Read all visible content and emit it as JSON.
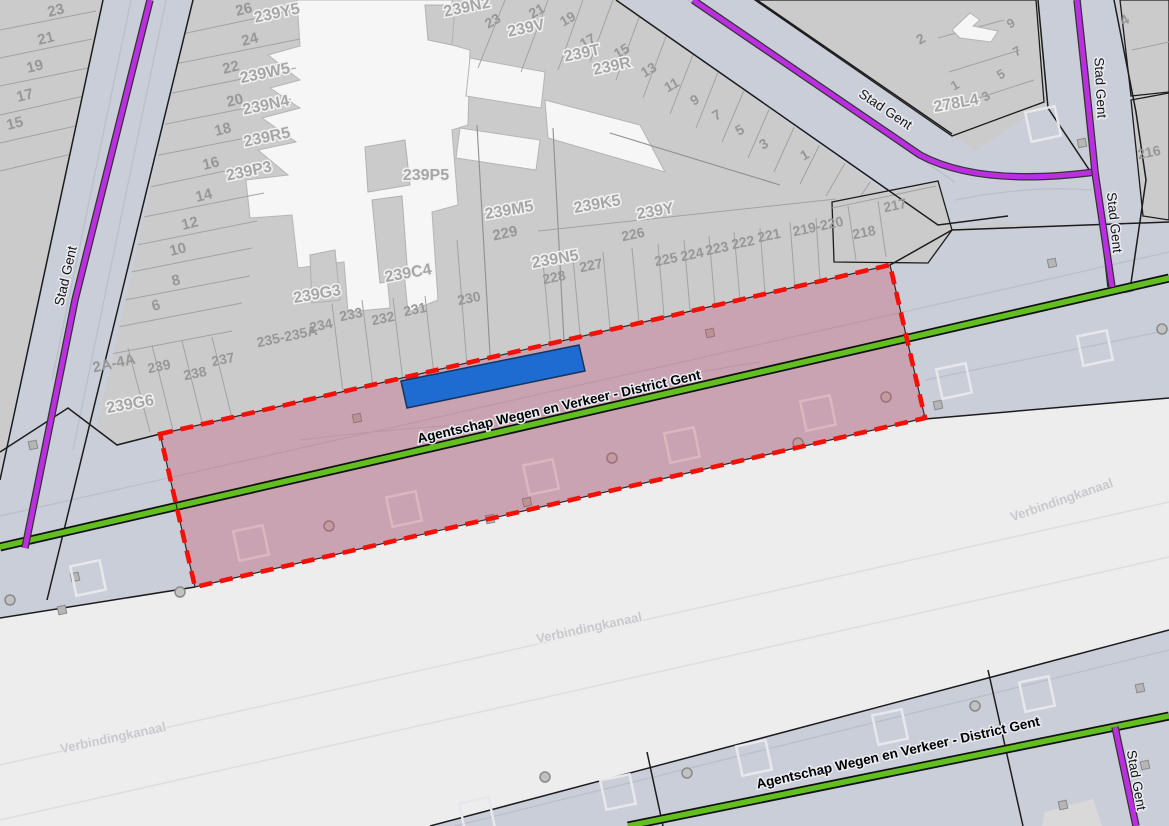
{
  "map": {
    "description": "Cadastral GIS map with selected road parcel",
    "colors": {
      "parcel_fill": "#cbcbcb",
      "road_fill": "#c9ced9",
      "canal_fill": "#ededee",
      "building_fill": "#f6f6f6",
      "selection_red": "#f50f05",
      "selection_pink_fill": "rgba(200,55,75,0.28)",
      "highlight_blue": "#1e6bd2",
      "road_line_green": "#62bf1f",
      "road_line_purple": "#bb2fe0"
    },
    "parcel_numbers": [
      {
        "t": "23",
        "x": 57,
        "y": 15,
        "r": -14,
        "fs": 15
      },
      {
        "t": "21",
        "x": 47,
        "y": 43,
        "r": -14,
        "fs": 15
      },
      {
        "t": "19",
        "x": 36,
        "y": 71,
        "r": -14,
        "fs": 15
      },
      {
        "t": "17",
        "x": 26,
        "y": 100,
        "r": -14,
        "fs": 15
      },
      {
        "t": "15",
        "x": 16,
        "y": 128,
        "r": -14,
        "fs": 15
      },
      {
        "t": "26",
        "x": 245,
        "y": 14,
        "r": -14,
        "fs": 15
      },
      {
        "t": "24",
        "x": 251,
        "y": 44,
        "r": -14,
        "fs": 15
      },
      {
        "t": "22",
        "x": 232,
        "y": 72,
        "r": -14,
        "fs": 15
      },
      {
        "t": "20",
        "x": 236,
        "y": 105,
        "r": -14,
        "fs": 15
      },
      {
        "t": "18",
        "x": 224,
        "y": 134,
        "r": -14,
        "fs": 15
      },
      {
        "t": "16",
        "x": 212,
        "y": 168,
        "r": -14,
        "fs": 15
      },
      {
        "t": "14",
        "x": 205,
        "y": 200,
        "r": -14,
        "fs": 15
      },
      {
        "t": "12",
        "x": 191,
        "y": 228,
        "r": -14,
        "fs": 15
      },
      {
        "t": "10",
        "x": 179,
        "y": 254,
        "r": -14,
        "fs": 15
      },
      {
        "t": "8",
        "x": 177,
        "y": 285,
        "r": -14,
        "fs": 15
      },
      {
        "t": "6",
        "x": 157,
        "y": 310,
        "r": -14,
        "fs": 15
      },
      {
        "t": "23",
        "x": 495,
        "y": 25,
        "r": -30,
        "fs": 14
      },
      {
        "t": "21",
        "x": 539,
        "y": 15,
        "r": -30,
        "fs": 14
      },
      {
        "t": "19",
        "x": 570,
        "y": 23,
        "r": -30,
        "fs": 14
      },
      {
        "t": "17",
        "x": 590,
        "y": 45,
        "r": -30,
        "fs": 14
      },
      {
        "t": "15",
        "x": 624,
        "y": 55,
        "r": -30,
        "fs": 14
      },
      {
        "t": "13",
        "x": 651,
        "y": 74,
        "r": -30,
        "fs": 14
      },
      {
        "t": "11",
        "x": 674,
        "y": 89,
        "r": -30,
        "fs": 14
      },
      {
        "t": "9",
        "x": 697,
        "y": 104,
        "r": -30,
        "fs": 14
      },
      {
        "t": "7",
        "x": 719,
        "y": 119,
        "r": -30,
        "fs": 14
      },
      {
        "t": "5",
        "x": 742,
        "y": 134,
        "r": -30,
        "fs": 14
      },
      {
        "t": "3",
        "x": 766,
        "y": 148,
        "r": -30,
        "fs": 14
      },
      {
        "t": "1",
        "x": 807,
        "y": 159,
        "r": -30,
        "fs": 14
      },
      {
        "t": "2",
        "x": 923,
        "y": 43,
        "r": -30,
        "fs": 14
      },
      {
        "t": "4",
        "x": 1127,
        "y": 24,
        "r": -30,
        "fs": 14
      },
      {
        "t": "9",
        "x": 1013,
        "y": 27,
        "r": -30,
        "fs": 13
      },
      {
        "t": "7",
        "x": 1019,
        "y": 55,
        "r": -30,
        "fs": 13
      },
      {
        "t": "5",
        "x": 1003,
        "y": 78,
        "r": -30,
        "fs": 13
      },
      {
        "t": "3",
        "x": 988,
        "y": 100,
        "r": -30,
        "fs": 13
      },
      {
        "t": "1",
        "x": 957,
        "y": 89,
        "r": -30,
        "fs": 13
      },
      {
        "t": "216",
        "x": 1150,
        "y": 157,
        "r": -12,
        "fs": 14
      },
      {
        "t": "217",
        "x": 896,
        "y": 210,
        "r": -12,
        "fs": 14
      },
      {
        "t": "218",
        "x": 865,
        "y": 237,
        "r": -12,
        "fs": 14
      },
      {
        "t": "219-220",
        "x": 819,
        "y": 231,
        "r": -12,
        "fs": 14
      },
      {
        "t": "221",
        "x": 770,
        "y": 240,
        "r": -12,
        "fs": 14
      },
      {
        "t": "222",
        "x": 744,
        "y": 247,
        "r": -12,
        "fs": 14
      },
      {
        "t": "223",
        "x": 718,
        "y": 253,
        "r": -12,
        "fs": 14
      },
      {
        "t": "224",
        "x": 693,
        "y": 259,
        "r": -12,
        "fs": 14
      },
      {
        "t": "225",
        "x": 667,
        "y": 264,
        "r": -12,
        "fs": 14
      },
      {
        "t": "226",
        "x": 634,
        "y": 239,
        "r": -12,
        "fs": 14
      },
      {
        "t": "227",
        "x": 592,
        "y": 270,
        "r": -12,
        "fs": 14
      },
      {
        "t": "228",
        "x": 555,
        "y": 282,
        "r": -12,
        "fs": 14
      },
      {
        "t": "229",
        "x": 506,
        "y": 238,
        "r": -12,
        "fs": 15
      },
      {
        "t": "230",
        "x": 470,
        "y": 303,
        "r": -12,
        "fs": 14
      },
      {
        "t": "231",
        "x": 416,
        "y": 314,
        "r": -12,
        "fs": 14
      },
      {
        "t": "232",
        "x": 384,
        "y": 323,
        "r": -12,
        "fs": 14
      },
      {
        "t": "233",
        "x": 352,
        "y": 319,
        "r": -12,
        "fs": 14
      },
      {
        "t": "234",
        "x": 322,
        "y": 330,
        "r": -12,
        "fs": 14
      },
      {
        "t": "235-235A",
        "x": 288,
        "y": 341,
        "r": -12,
        "fs": 14
      },
      {
        "t": "237",
        "x": 224,
        "y": 364,
        "r": -12,
        "fs": 14
      },
      {
        "t": "238",
        "x": 196,
        "y": 378,
        "r": -12,
        "fs": 14
      },
      {
        "t": "239",
        "x": 160,
        "y": 371,
        "r": -12,
        "fs": 14
      },
      {
        "t": "2A-4A",
        "x": 115,
        "y": 368,
        "r": -12,
        "fs": 15
      }
    ],
    "parcel_codes": [
      {
        "t": "239Y5",
        "x": 278,
        "y": 18,
        "r": -12
      },
      {
        "t": "239W5",
        "x": 266,
        "y": 78,
        "r": -12
      },
      {
        "t": "239N4",
        "x": 267,
        "y": 110,
        "r": -12
      },
      {
        "t": "239R5",
        "x": 268,
        "y": 142,
        "r": -12
      },
      {
        "t": "239P3",
        "x": 250,
        "y": 176,
        "r": -12
      },
      {
        "t": "239N2",
        "x": 468,
        "y": 12,
        "r": -12
      },
      {
        "t": "239V",
        "x": 527,
        "y": 33,
        "r": -12
      },
      {
        "t": "239T",
        "x": 583,
        "y": 58,
        "r": -12
      },
      {
        "t": "239R",
        "x": 613,
        "y": 71,
        "r": -12
      },
      {
        "t": "239P5",
        "x": 426,
        "y": 180,
        "r": 0
      },
      {
        "t": "239M5",
        "x": 510,
        "y": 215,
        "r": -10
      },
      {
        "t": "239K5",
        "x": 598,
        "y": 209,
        "r": -10
      },
      {
        "t": "239Y",
        "x": 656,
        "y": 216,
        "r": -10
      },
      {
        "t": "239N5",
        "x": 556,
        "y": 264,
        "r": -10
      },
      {
        "t": "239C4",
        "x": 409,
        "y": 278,
        "r": -10
      },
      {
        "t": "239G3",
        "x": 318,
        "y": 299,
        "r": -10
      },
      {
        "t": "239G6",
        "x": 131,
        "y": 409,
        "r": -10
      },
      {
        "t": "278L4",
        "x": 957,
        "y": 108,
        "r": -10
      }
    ],
    "road_labels": [
      {
        "t": "Stad Gent",
        "x": 70,
        "y": 277,
        "r": -77
      },
      {
        "t": "Stad Gent",
        "x": 883,
        "y": 113,
        "r": 34
      },
      {
        "t": "Stad Gent",
        "x": 1096,
        "y": 88,
        "r": 87
      },
      {
        "t": "Stad Gent",
        "x": 1110,
        "y": 223,
        "r": 84
      },
      {
        "t": "Stad Gent",
        "x": 1132,
        "y": 781,
        "r": 80
      }
    ],
    "agency_labels": [
      {
        "t": "Agentschap Wegen en Verkeer - District Gent",
        "x": 560,
        "y": 411,
        "r": -12.8
      },
      {
        "t": "Agentschap Wegen en Verkeer - District Gent",
        "x": 899,
        "y": 757,
        "r": -12.6
      }
    ],
    "canal_labels": [
      {
        "t": "Verbindingkanaal",
        "x": 114,
        "y": 742,
        "r": -12
      },
      {
        "t": "Verbindingkanaal",
        "x": 590,
        "y": 632,
        "r": -12
      },
      {
        "t": "Verbindingkanaal",
        "x": 1063,
        "y": 504,
        "r": -19
      }
    ],
    "symbols": {
      "small_squares": [
        [
          357,
          418
        ],
        [
          527,
          502
        ],
        [
          490,
          519
        ],
        [
          710,
          333
        ],
        [
          938,
          405
        ],
        [
          1052,
          263
        ],
        [
          1128,
          288
        ],
        [
          33,
          445
        ],
        [
          75,
          577
        ],
        [
          62,
          610
        ],
        [
          1082,
          143
        ],
        [
          1140,
          688
        ],
        [
          1145,
          765
        ],
        [
          1063,
          805
        ]
      ],
      "outline_squares": [
        [
          251,
          543
        ],
        [
          404,
          509
        ],
        [
          541,
          477
        ],
        [
          682,
          445
        ],
        [
          818,
          413
        ],
        [
          1095,
          348
        ],
        [
          954,
          381
        ],
        [
          1043,
          124
        ],
        [
          618,
          792
        ],
        [
          754,
          758
        ],
        [
          477,
          815
        ],
        [
          890,
          727
        ],
        [
          1037,
          694
        ],
        [
          88,
          578
        ]
      ],
      "circles": [
        [
          329,
          526
        ],
        [
          612,
          458
        ],
        [
          886,
          397
        ],
        [
          1162,
          329
        ],
        [
          798,
          443
        ],
        [
          545,
          777
        ],
        [
          687,
          773
        ],
        [
          975,
          706
        ],
        [
          180,
          592
        ],
        [
          10,
          600
        ]
      ]
    },
    "selection": {
      "corners": [
        [
          160,
          434
        ],
        [
          890,
          265
        ],
        [
          925,
          418
        ],
        [
          195,
          587
        ]
      ],
      "highlight_rect": [
        [
          401,
          381
        ],
        [
          579,
          345
        ],
        [
          585,
          371
        ],
        [
          407,
          408
        ]
      ]
    }
  }
}
